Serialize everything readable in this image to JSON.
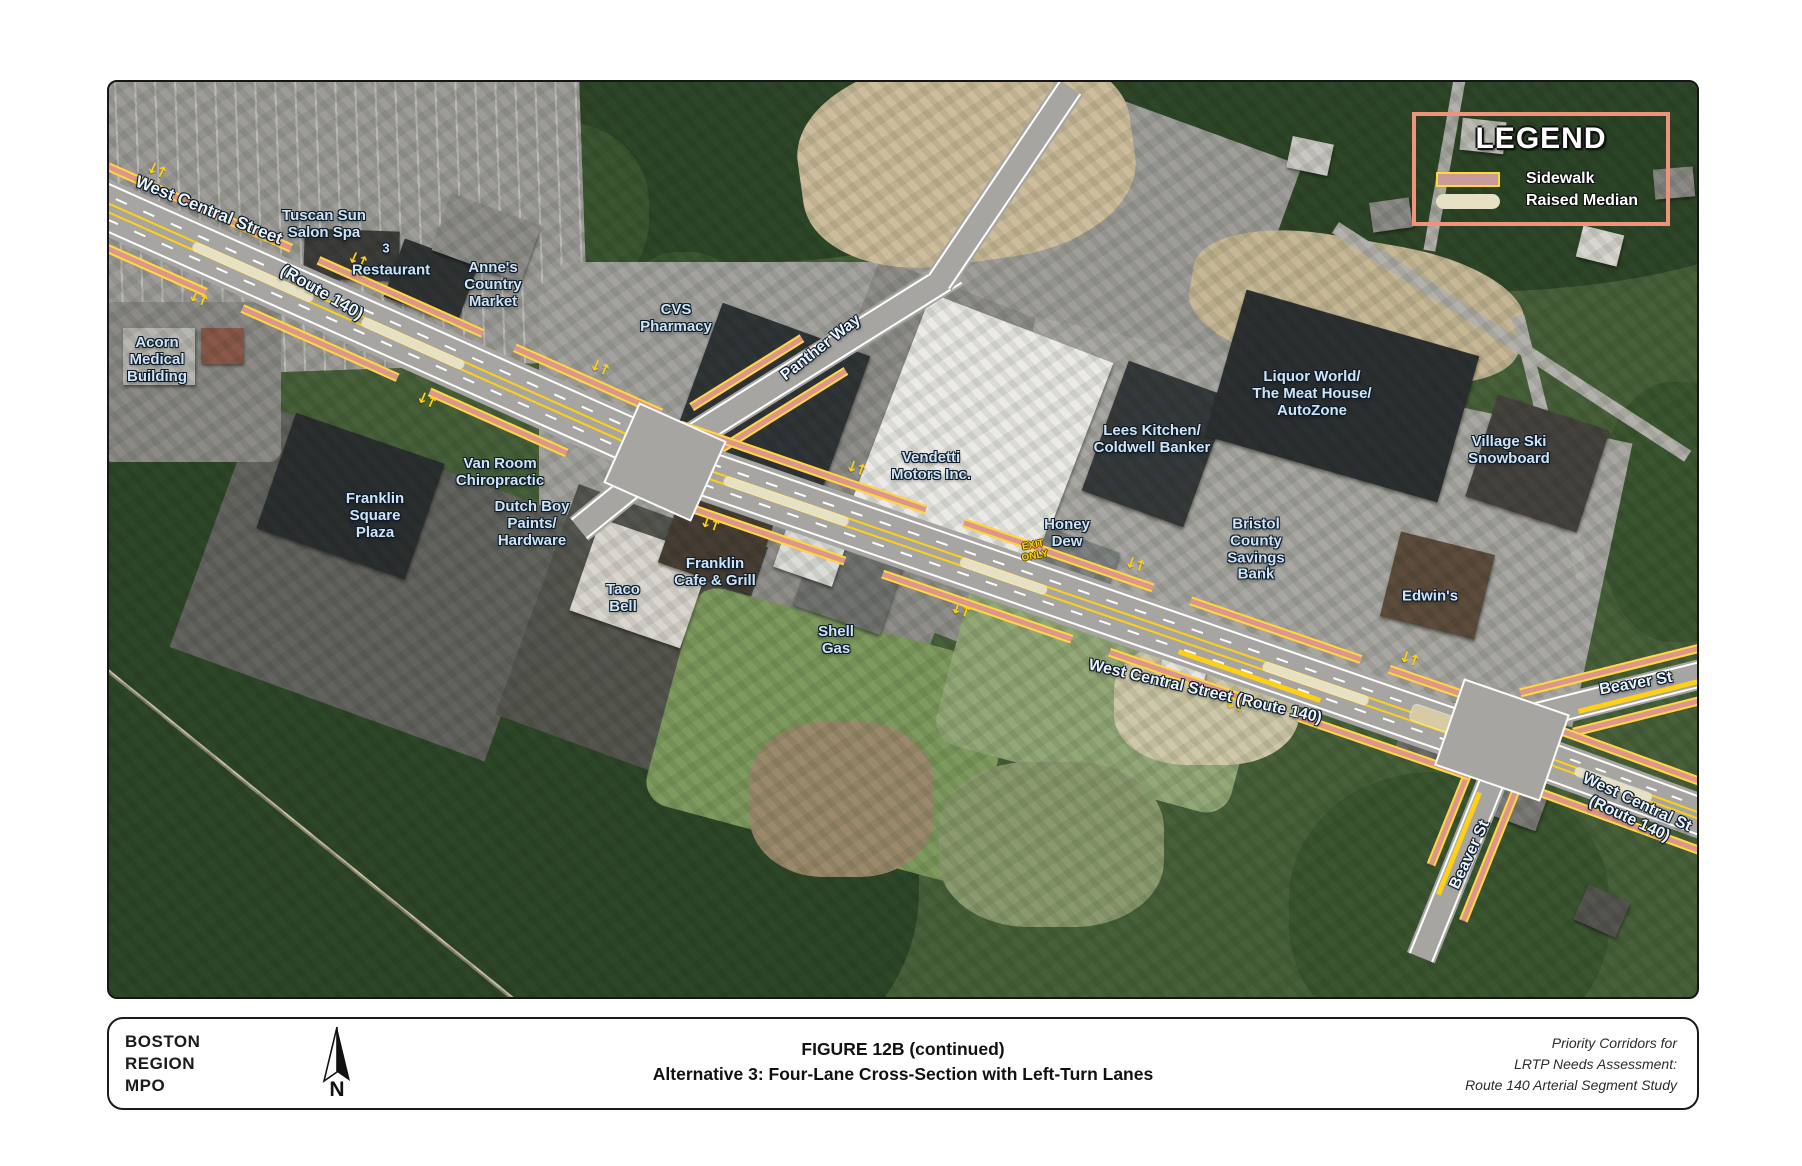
{
  "colors": {
    "sidewalk": "#dd968b",
    "sidewalk_edge": "#ffd83d",
    "raised_median": "#e6e0c4",
    "lane_yellow": "#ffd016",
    "legend_border": "#ef947a",
    "label_blue": "#cfe4f5",
    "road_gray": "#a6a5a1"
  },
  "icons": {
    "lane_arrows": "↓↑",
    "north_arrow": "north-arrow"
  },
  "map": {
    "legend": {
      "title": "LEGEND",
      "items": [
        {
          "label": "Sidewalk",
          "swatch": "sidewalk"
        },
        {
          "label": "Raised Median",
          "swatch": "raised-median"
        }
      ]
    },
    "labels": [
      {
        "id": "west-central-street-tl",
        "lines": [
          "West Central Street"
        ],
        "x": 100,
        "y": 128,
        "rot": 22,
        "size": 17,
        "cls": "street"
      },
      {
        "id": "route-140-tl",
        "lines": [
          "(Route 140)"
        ],
        "x": 213,
        "y": 210,
        "rot": 30,
        "size": 17,
        "cls": "street"
      },
      {
        "id": "tuscan-sun-salon-spa",
        "lines": [
          "Tuscan Sun",
          "Salon Spa"
        ],
        "x": 215,
        "y": 143
      },
      {
        "id": "restaurant-3",
        "lines": [
          "3"
        ],
        "x": 277,
        "y": 167,
        "size": 13
      },
      {
        "id": "restaurant",
        "lines": [
          "Restaurant"
        ],
        "x": 282,
        "y": 189
      },
      {
        "id": "annes-country-market",
        "lines": [
          "Anne's",
          "Country",
          "Market"
        ],
        "x": 384,
        "y": 203
      },
      {
        "id": "cvs-pharmacy",
        "lines": [
          "CVS",
          "Pharmacy"
        ],
        "x": 567,
        "y": 237
      },
      {
        "id": "panther-way",
        "lines": [
          "Panther Way"
        ],
        "x": 712,
        "y": 266,
        "rot": -38,
        "size": 16,
        "cls": "street"
      },
      {
        "id": "acorn-medical-building",
        "lines": [
          "Acorn",
          "Medical",
          "Building"
        ],
        "x": 48,
        "y": 278
      },
      {
        "id": "franklin-square-plaza",
        "lines": [
          "Franklin",
          "Square",
          "Plaza"
        ],
        "x": 266,
        "y": 434
      },
      {
        "id": "van-room-chiropractic",
        "lines": [
          "Van Room",
          "Chiropractic"
        ],
        "x": 391,
        "y": 391
      },
      {
        "id": "dutch-boy-paints-hardware",
        "lines": [
          "Dutch Boy",
          "Paints/",
          "Hardware"
        ],
        "x": 423,
        "y": 442
      },
      {
        "id": "taco-bell",
        "lines": [
          "Taco",
          "Bell"
        ],
        "x": 514,
        "y": 517
      },
      {
        "id": "franklin-cafe-grill",
        "lines": [
          "Franklin",
          "Cafe & Grill"
        ],
        "x": 606,
        "y": 491
      },
      {
        "id": "shell-gas",
        "lines": [
          "Shell",
          "Gas"
        ],
        "x": 727,
        "y": 559
      },
      {
        "id": "vendetti-motors",
        "lines": [
          "Vendetti",
          "Motors Inc."
        ],
        "x": 822,
        "y": 385
      },
      {
        "id": "exit-only",
        "lines": [
          "EXIT",
          "ONLY"
        ],
        "x": 925,
        "y": 469,
        "rot": -10,
        "size": 10,
        "cls": "yellow"
      },
      {
        "id": "lees-kitchen-coldwell-banker",
        "lines": [
          "Lees Kitchen/",
          "Coldwell Banker"
        ],
        "x": 1043,
        "y": 358
      },
      {
        "id": "honey-dew",
        "lines": [
          "Honey",
          "Dew"
        ],
        "x": 958,
        "y": 452
      },
      {
        "id": "liquor-world-meat-house-autozone",
        "lines": [
          "Liquor World/",
          "The Meat House/",
          "AutoZone"
        ],
        "x": 1203,
        "y": 312
      },
      {
        "id": "bristol-county-savings-bank",
        "lines": [
          "Bristol",
          "County",
          "Savings",
          "Bank"
        ],
        "x": 1147,
        "y": 468
      },
      {
        "id": "village-ski-snowboard",
        "lines": [
          "Village Ski",
          "Snowboard"
        ],
        "x": 1400,
        "y": 369
      },
      {
        "id": "edwins",
        "lines": [
          "Edwin's"
        ],
        "x": 1321,
        "y": 515
      },
      {
        "id": "west-central-street-mid",
        "lines": [
          "West Central Street (Route 140)"
        ],
        "x": 1096,
        "y": 610,
        "rot": 13,
        "size": 16,
        "cls": "street"
      },
      {
        "id": "beaver-st-ne",
        "lines": [
          "Beaver St"
        ],
        "x": 1527,
        "y": 602,
        "rot": -10,
        "size": 16,
        "cls": "street"
      },
      {
        "id": "west-central-st-right",
        "lines": [
          "West Central St",
          "(Route 140)"
        ],
        "x": 1524,
        "y": 729,
        "rot": 25,
        "size": 16,
        "cls": "street"
      },
      {
        "id": "beaver-st-s",
        "lines": [
          "Beaver St"
        ],
        "x": 1361,
        "y": 773,
        "rot": -65,
        "size": 16,
        "cls": "street"
      }
    ]
  },
  "footer": {
    "org_lines": [
      "BOSTON",
      "REGION",
      "MPO"
    ],
    "north_label": "N",
    "title_line1": "FIGURE 12B (continued)",
    "title_line2": "Alternative 3: Four-Lane Cross-Section with Left-Turn Lanes",
    "credit_lines": [
      "Priority Corridors for",
      "LRTP Needs Assessment:",
      "Route 140 Arterial Segment Study"
    ]
  }
}
